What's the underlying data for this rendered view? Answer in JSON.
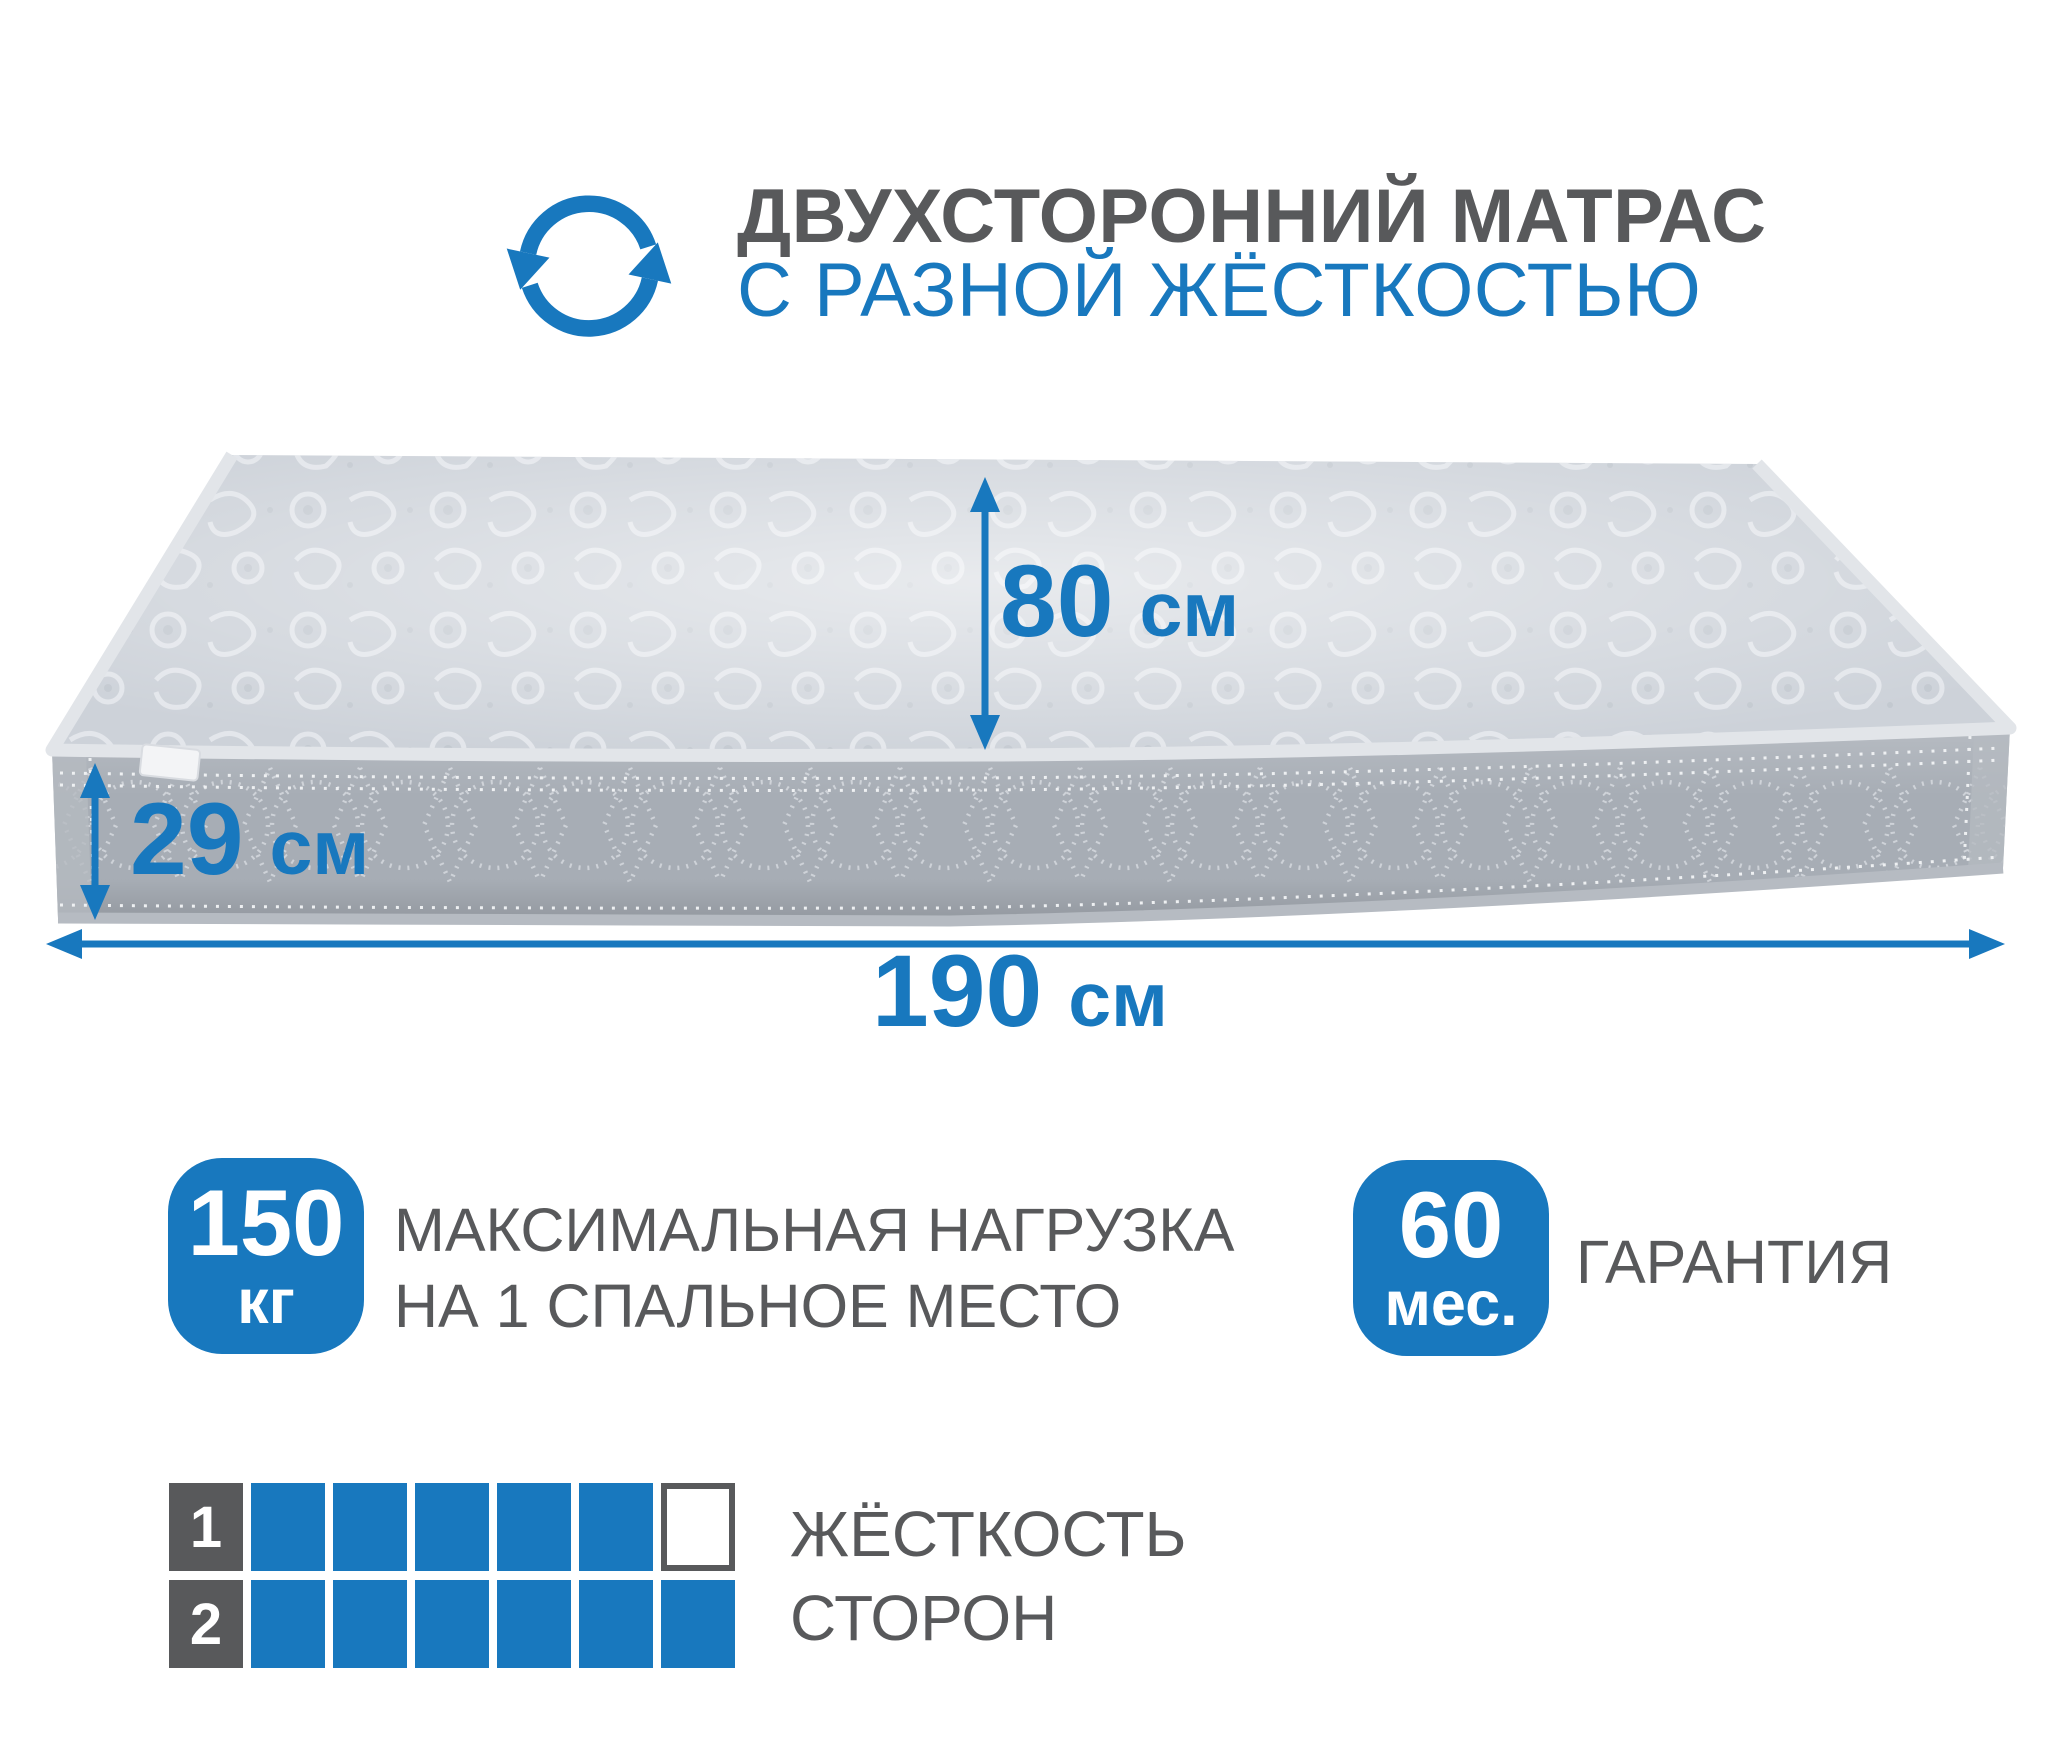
{
  "colors": {
    "accent_blue": "#1878be",
    "heading_gray": "#58595b",
    "mattress_top": "#cdd2d9",
    "mattress_side": "#a7adb5",
    "piping_light": "#e2e5e9"
  },
  "header": {
    "icon": "rotate-arrows-icon",
    "title_line1": "ДВУХСТОРОННИЙ МАТРАС",
    "title_line2": "С РАЗНОЙ ЖЁСТКОСТЬЮ"
  },
  "dimensions": {
    "bed_width": {
      "value": "80",
      "unit": "см"
    },
    "height": {
      "value": "29",
      "unit": "см"
    },
    "length": {
      "value": "190",
      "unit": "см"
    }
  },
  "features": {
    "max_load": {
      "value": "150",
      "unit": "кг",
      "label_line1": "МАКСИМАЛЬНАЯ НАГРУЗКА",
      "label_line2": "НА 1 СПАЛЬНОЕ МЕСТО"
    },
    "warranty": {
      "value": "60",
      "unit": "мес.",
      "label": "ГАРАНТИЯ"
    }
  },
  "firmness": {
    "label_line1": "ЖЁСТКОСТЬ",
    "label_line2": "СТОРОН",
    "scale_max": 6,
    "rows": [
      {
        "side": "1",
        "filled": 5
      },
      {
        "side": "2",
        "filled": 6
      }
    ]
  }
}
